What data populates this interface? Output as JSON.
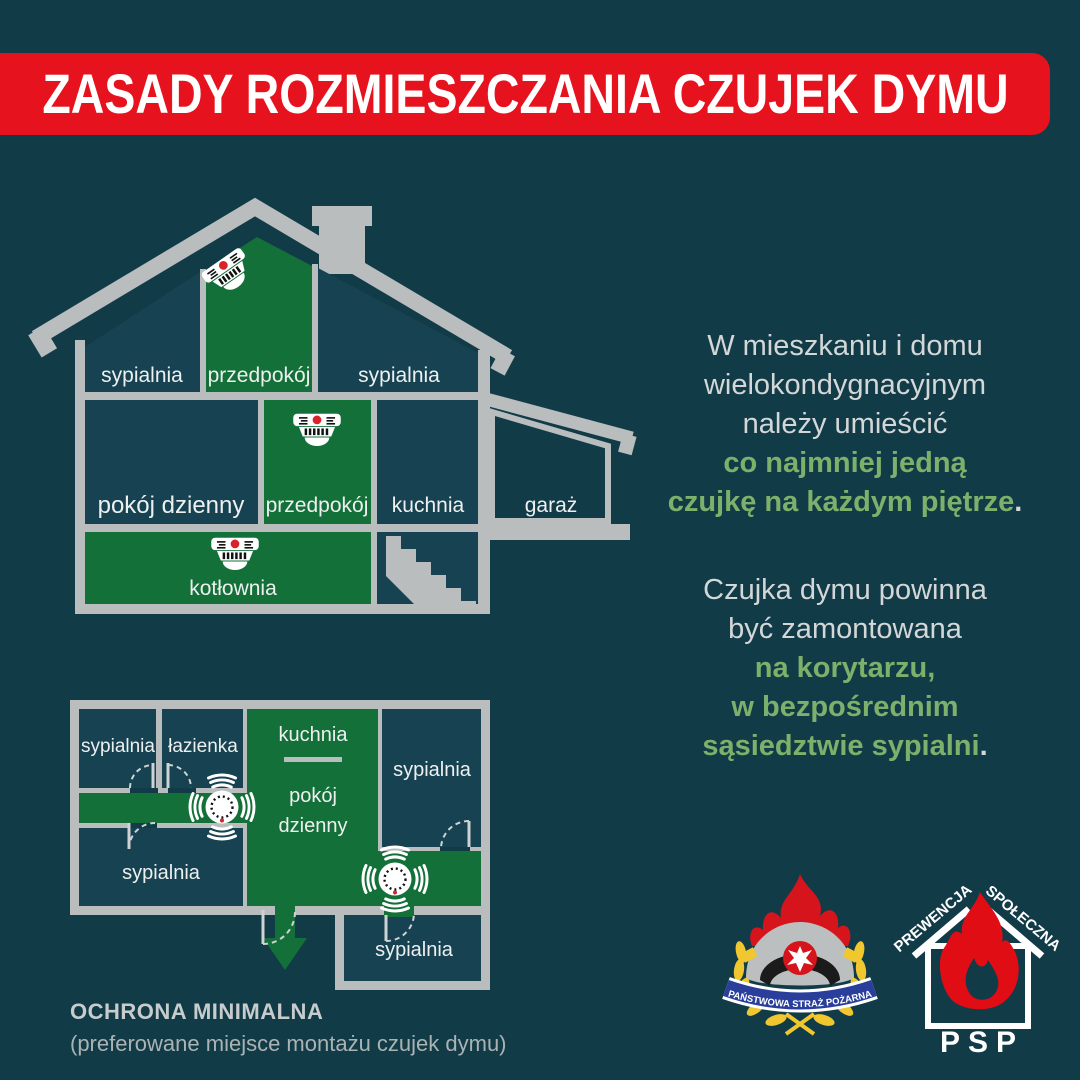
{
  "banner": {
    "title": "ZASADY ROZMIESZCZANIA CZUJEK DYMU",
    "bg_color": "#e6131e"
  },
  "colors": {
    "background": "#123b48",
    "room_dark": "#164252",
    "room_green": "#147039",
    "wall_gray": "#b9bdbe",
    "text_white": "#eef0f0",
    "text_gray": "#d3d7d7",
    "text_green": "#7db06a",
    "detector_red": "#d8232a"
  },
  "house": {
    "attic": {
      "left": "sypialnia",
      "hall": "przedpokój",
      "right": "sypialnia"
    },
    "ground": {
      "living": "pokój dzienny",
      "hall": "przedpokój",
      "kitchen": "kuchnia",
      "garage": "garaż"
    },
    "basement": {
      "boiler": "kotłownia"
    }
  },
  "plan": {
    "bedroom_tl": "sypialnia",
    "bathroom": "łazienka",
    "kitchen": "kuchnia",
    "living_line1": "pokój",
    "living_line2": "dzienny",
    "bedroom_r": "sypialnia",
    "bedroom_bl": "sypialnia",
    "bedroom_annex": "sypialnia",
    "caption_title": "OCHRONA MINIMALNA",
    "caption_sub": "(preferowane miejsce montażu czujek dymu)"
  },
  "paragraph1": {
    "l1": "W mieszkaniu i domu",
    "l2": "wielokondygnacyjnym",
    "l3": "należy umieścić",
    "g1": "co najmniej jedną",
    "g2": "czujkę na każdym piętrze",
    "dot": "."
  },
  "paragraph2": {
    "l1": "Czujka dymu powinna",
    "l2": "być zamontowana",
    "g1": "na korytarzu,",
    "g2": "w bezpośrednim",
    "g3": "sąsiedztwie sypialni",
    "dot": "."
  },
  "logos": {
    "psp_ribbon": "PAŃSTWOWA STRAŻ POŻARNA",
    "prev_left": "PREWENCJA",
    "prev_right": "SPOŁECZNA",
    "prev_bottom": "PSP"
  }
}
